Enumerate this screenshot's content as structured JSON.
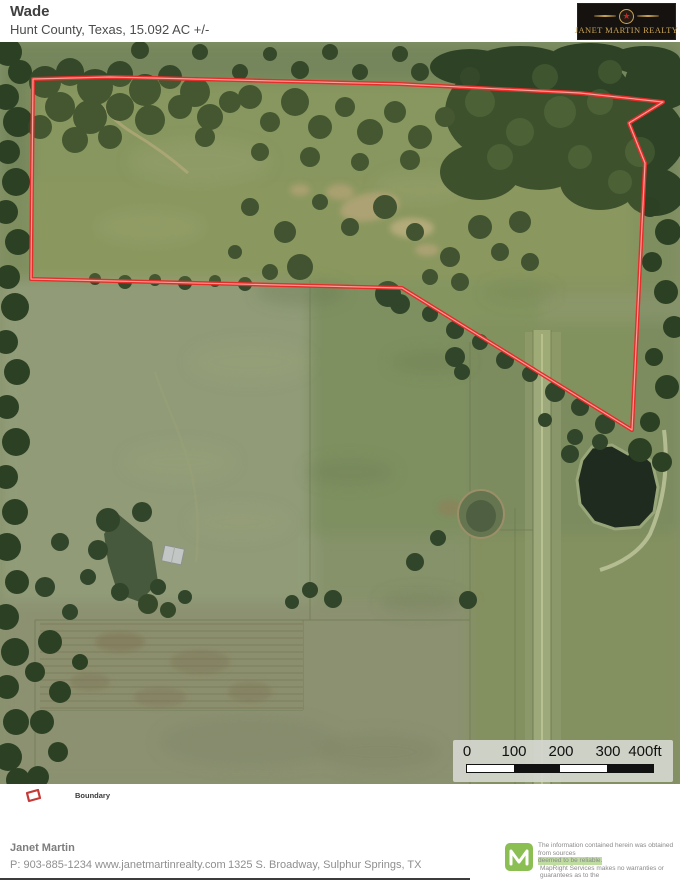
{
  "header": {
    "title": "Wade",
    "subtitle": "Hunt County, Texas, 15.092 AC +/-",
    "logo_text": "JANET MARTIN REALTY",
    "logo_star": "★",
    "logo_colors": {
      "background": "#161210",
      "gold": "#c9a558",
      "star_red": "#c0281f"
    }
  },
  "map": {
    "type": "aerial-satellite",
    "county": "Hunt County, Texas",
    "acreage": "15.092 AC +/-",
    "boundary": {
      "label": "Boundary",
      "color": "#e0302b",
      "points": [
        [
          33,
          37
        ],
        [
          110,
          35
        ],
        [
          400,
          42
        ],
        [
          580,
          51
        ],
        [
          663,
          60
        ],
        [
          629,
          81
        ],
        [
          645,
          121
        ],
        [
          632,
          388
        ],
        [
          402,
          246
        ],
        [
          31,
          237
        ]
      ]
    },
    "scale_bar": {
      "labels": [
        "0",
        "100",
        "200",
        "300",
        "400ft"
      ]
    }
  },
  "legend": {
    "items": [
      {
        "label": "Boundary",
        "color": "#c43a36"
      }
    ]
  },
  "footer": {
    "agent": "Janet Martin",
    "phone": "P: 903-885-1234",
    "website": "www.janetmartinrealty.com",
    "address": "1325 S. Broadway, Sulphur Springs, TX",
    "mapright_green": "#8bbf54",
    "disclaimer_lines": [
      "The information contained herein was obtained from sources",
      "deemed to be reliable.",
      "MapRight Services makes no warranties or guarantees as to the",
      "completeness or accuracy thereof."
    ]
  }
}
